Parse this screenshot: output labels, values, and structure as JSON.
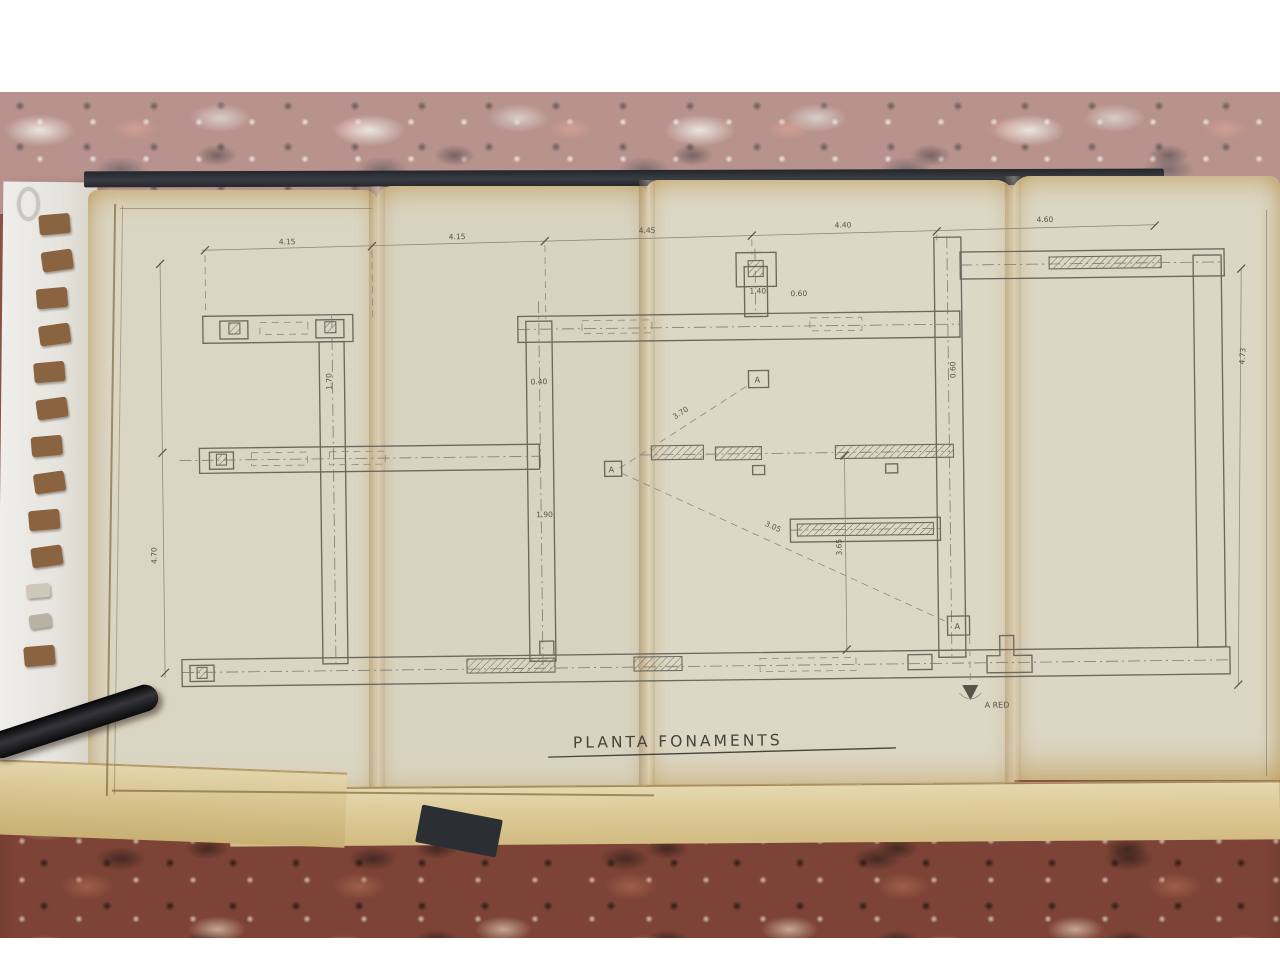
{
  "palette": {
    "granite_top": "#b8928c",
    "granite_bottom": "#7c4336",
    "paper": "#dbd6c3",
    "paper_edge": "#d2bb82",
    "binder": "#2b2e33",
    "comb": "#8a6340",
    "ink": "#6b695f"
  },
  "drawing": {
    "title": "PLANTA  FONAMENTS",
    "marker_label": "A",
    "anchor_label": "A RED",
    "dims_top": [
      "4.15",
      "4.15",
      "4.45",
      "4.40",
      "4.60"
    ],
    "dims_side": {
      "left": "4.70",
      "right": "4.73"
    },
    "dims_small": [
      "0.40",
      "1.90",
      "1.40",
      "0.60",
      "3.65",
      "3.70",
      "3.05",
      "1.70",
      "0.60"
    ]
  }
}
